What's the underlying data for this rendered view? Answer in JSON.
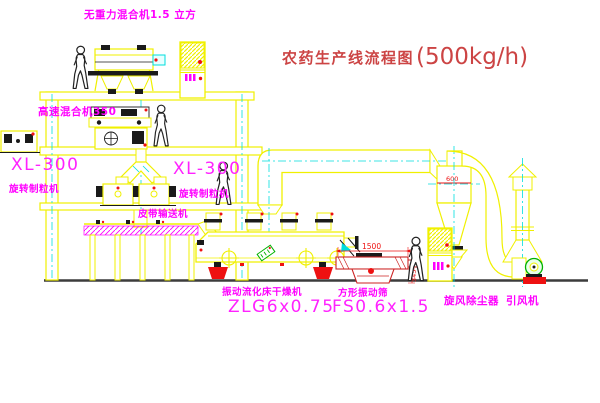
{
  "title": {
    "text_cn": "农药生产线流程图",
    "capacity": "(500kg/h)"
  },
  "equipment_labels": {
    "gravity_free_mixer": "无重力混合机1.5 立方",
    "high_speed_mixer": "高速混合机350",
    "granulator_left": {
      "model": "XL-300",
      "name": "旋转制粒机"
    },
    "granulator_mid": {
      "model": "XL-300",
      "name": "旋转制粒机"
    },
    "belt_conveyor": "皮带输送机",
    "fluid_bed_dryer": {
      "name": "振动流化床干燥机",
      "model": "ZLG6x0.75"
    },
    "square_vibrating_sieve": {
      "name": "方形振动筛",
      "model": "FS0.6x1.5"
    },
    "cyclone_dust_collector": "旋风除尘器",
    "induced_draft_fan": "引风机"
  },
  "dimensions": {
    "sieve_width": "1500",
    "sieve_height": "345",
    "cyclone_dim": "600"
  },
  "colors": {
    "line_yellow": "#f0f000",
    "centerline_cyan": "#00dede",
    "label_magenta": "#ff00ff",
    "title_red": "#cc4444",
    "dim_red": "#ee1111",
    "machine_green": "#00b300"
  }
}
